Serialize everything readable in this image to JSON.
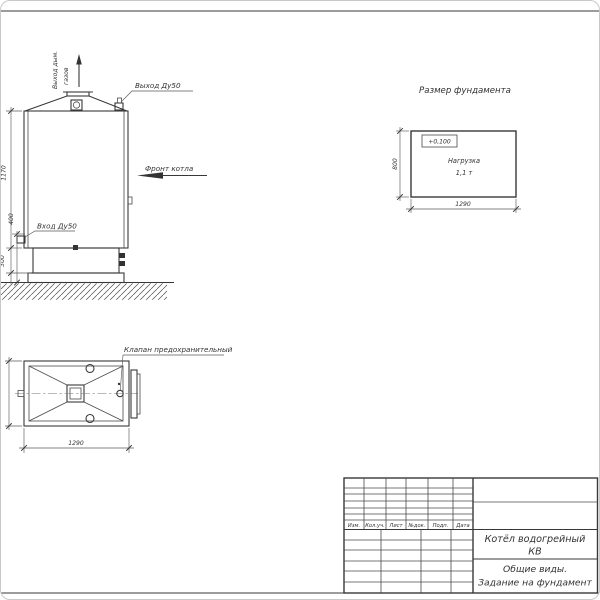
{
  "colors": {
    "ink": "#383838",
    "paper": "#ffffff"
  },
  "front_view": {
    "flue_line1": "Выход дым.",
    "flue_line2": "газов",
    "outlet_label": "Выход Ду50",
    "front_label": "Фронт котла",
    "inlet_label": "Вход Ду50",
    "dim_height": "1170",
    "dim_inlet_height": "400",
    "dim_base_height": "300"
  },
  "foundation_view": {
    "title": "Размер фундамента",
    "elevation_mark": "+0,100",
    "load_line1": "Нагрузка",
    "load_line2": "1,1 т",
    "dim_length": "1290",
    "dim_width": "800"
  },
  "top_view": {
    "valve_label": "Клапан предохранительный",
    "dim_length": "1290"
  },
  "title_block": {
    "columns": [
      "Изм.",
      "Кол.уч.",
      "Лист",
      "№док.",
      "Подп.",
      "Дата"
    ],
    "product_line1": "Котёл водогрейный",
    "product_line2": "КВ",
    "doc_line1": "Общие виды.",
    "doc_line2": "Задание на фундамент"
  }
}
